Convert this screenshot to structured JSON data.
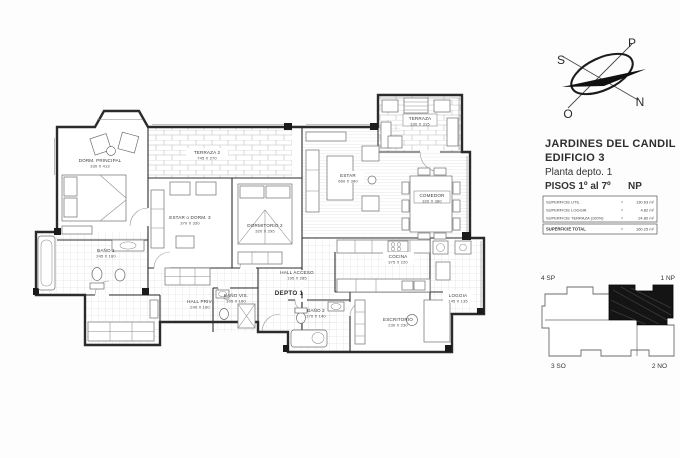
{
  "title_block": {
    "line1": "JARDINES DEL CANDIL",
    "line2": "EDIFICIO 3",
    "line3": "Planta depto.  1",
    "line4": "PISOS  1º al 7º",
    "line4_right": "NP"
  },
  "area_table": {
    "equals": "=",
    "rows": [
      {
        "label": "SUPERFICIE UTIL",
        "value": "130.63 m²"
      },
      {
        "label": "SUPERFICIE LOGGIA",
        "value": "4.82 m²"
      },
      {
        "label": "SUPERFICIE TERRAZA (100%)",
        "value": "24.80 m²"
      }
    ],
    "total": {
      "label": "SUPERFICIE TOTAL",
      "value": "160.25 m²"
    }
  },
  "compass": {
    "top": "P",
    "left": "S",
    "right": "N",
    "bottom": "O"
  },
  "key_plan": {
    "top_left": "4  SP",
    "top_right": "1  NP",
    "bottom_left": "3  SO",
    "bottom_right": "2  NO"
  },
  "plan": {
    "unit_label": "DEPTO 1",
    "rooms": [
      {
        "name": "DORM. PRINCIPAL",
        "dims": "330 X 413"
      },
      {
        "name": "TERRAZA 2",
        "dims": "745 X 270"
      },
      {
        "name": "ESTAR o DORM. 3",
        "dims": "370 X 330"
      },
      {
        "name": "DORMITORIO 2",
        "dims": "320 X 295"
      },
      {
        "name": "ESTAR",
        "dims": "660 X 380"
      },
      {
        "name": "COMEDOR",
        "dims": "320 X 380"
      },
      {
        "name": "TERRAZA",
        "dims": "330 X 315"
      },
      {
        "name": "COCINA",
        "dims": "375 X 220"
      },
      {
        "name": "LOGGIA",
        "dims": "145 X 135"
      },
      {
        "name": "ESCRITORIO",
        "dims": "230 X 230"
      },
      {
        "name": "BAÑO 1",
        "dims": "245 X 160"
      },
      {
        "name": "BAÑO 2",
        "dims": "170 X 140"
      },
      {
        "name": "BAÑO VIS.",
        "dims": "105 X 160"
      },
      {
        "name": "HALL ACCESO",
        "dims": "195 X 285"
      },
      {
        "name": "HALL PRIV.",
        "dims": "240 X 180"
      }
    ]
  }
}
